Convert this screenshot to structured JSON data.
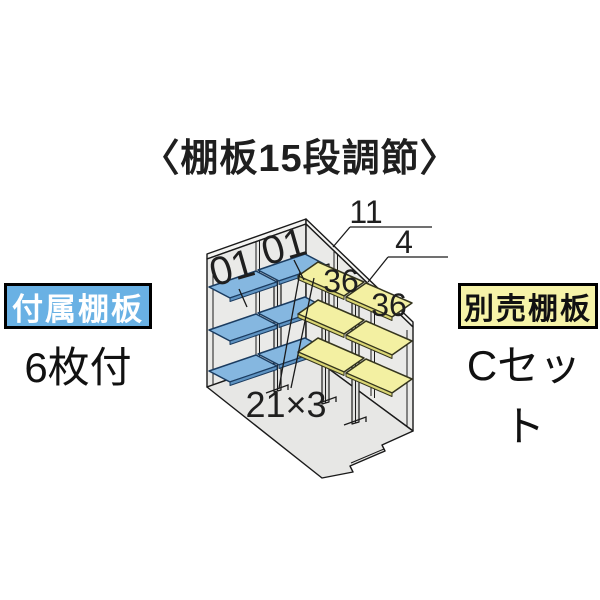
{
  "title": "〈棚板15段調節〉",
  "attached": {
    "label": "付属棚板",
    "note": "6枚付",
    "board_count": 6
  },
  "optional": {
    "label": "別売棚板",
    "note": "Cセット",
    "board_count": 6
  },
  "callouts": {
    "left_panel_1": "01",
    "left_panel_2": "01",
    "back_panel_1": "11",
    "back_panel_2": "4",
    "right_shelf_1": "36",
    "right_shelf_2": "36",
    "posts": "21×3"
  },
  "colors": {
    "attached_shelf": "#85B7E0",
    "attached_label_bg": "#69B1E4",
    "optional_shelf": "#F3F0A2",
    "optional_label_bg": "#F6F3A8",
    "wall": "#EAEAE8",
    "floor": "#E7E7E5",
    "outline": "#1A1A1A"
  }
}
